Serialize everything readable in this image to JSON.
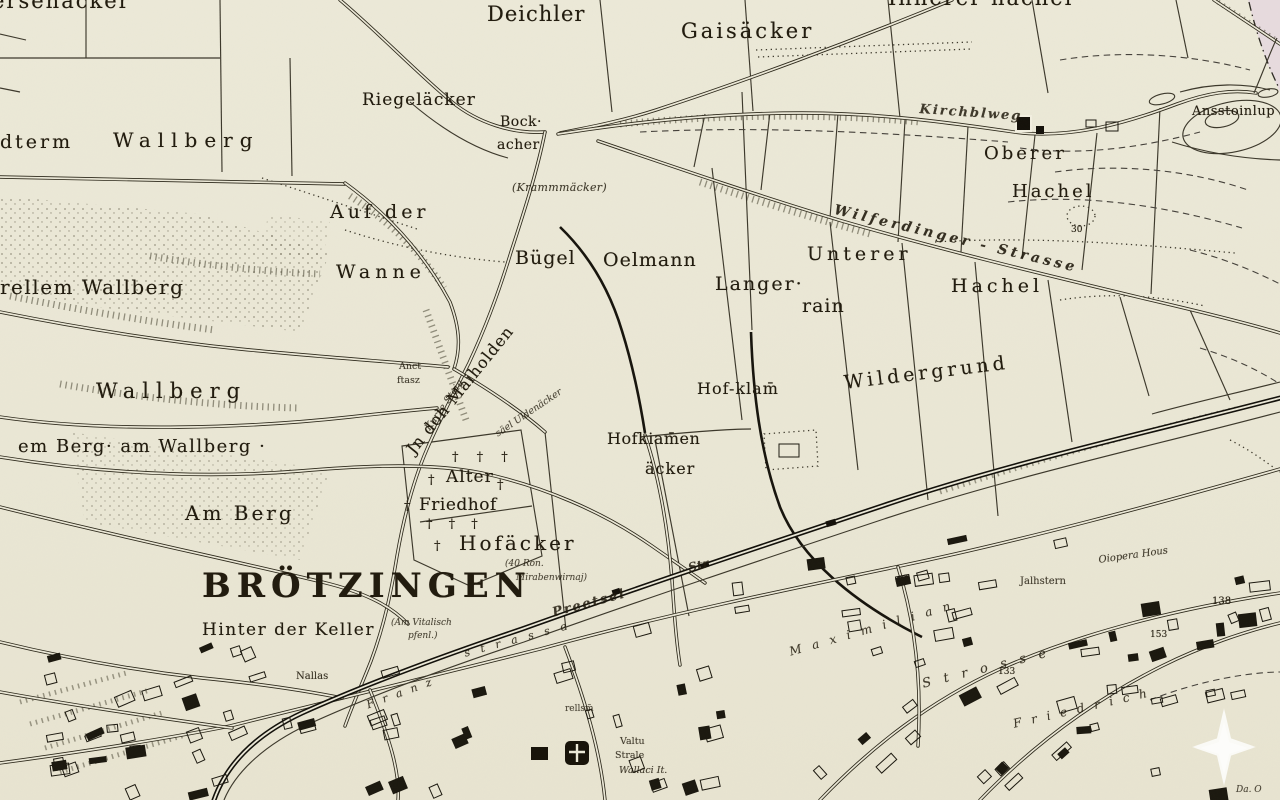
{
  "map": {
    "town_name": "BRÖTZINGEN",
    "colors": {
      "paper": "#ebe8d7",
      "ink": "#211c10",
      "edge_pink": "#e7dade",
      "railway_ink": "#12100a",
      "highlight": "rgba(255,255,255,0.78)"
    },
    "overlay_icon": "four-pointed-star-highlight",
    "labels": [
      {
        "id": "ersenaecker",
        "text": "ersenäcker",
        "x": -8,
        "y": -9,
        "s": 21,
        "ls": 2
      },
      {
        "id": "deichler",
        "text": "Deichler",
        "x": 487,
        "y": 4,
        "s": 21,
        "ls": 1
      },
      {
        "id": "gaisaecker",
        "text": "Gaisäcker",
        "x": 681,
        "y": 21,
        "s": 21,
        "ls": 3
      },
      {
        "id": "innerer-hachel",
        "text": "Innerer hachel",
        "x": 888,
        "y": -12,
        "s": 21,
        "ls": 2
      },
      {
        "id": "dterm",
        "text": "dterm",
        "x": 0,
        "y": 133,
        "s": 19,
        "ls": 3
      },
      {
        "id": "wallberg-nw",
        "text": "Wallberg",
        "x": 113,
        "y": 130,
        "s": 20,
        "ls": 7
      },
      {
        "id": "riegelaecker",
        "text": "Riegeläcker",
        "x": 362,
        "y": 92,
        "s": 17,
        "ls": 1
      },
      {
        "id": "bock",
        "text": "Bock·",
        "x": 500,
        "y": 115,
        "s": 14,
        "ls": 0.5
      },
      {
        "id": "acher",
        "text": "acher",
        "x": 497,
        "y": 138,
        "s": 14,
        "ls": 0.5
      },
      {
        "id": "krammaecker",
        "text": "(Krammmäcker)",
        "x": 512,
        "y": 182,
        "s": 11,
        "ls": 0.3,
        "it": 1,
        "op": 0.85
      },
      {
        "id": "auf-der",
        "text": "Auf der",
        "x": 330,
        "y": 203,
        "s": 19,
        "ls": 4
      },
      {
        "id": "wanne",
        "text": "Wanne",
        "x": 336,
        "y": 263,
        "s": 19,
        "ls": 5
      },
      {
        "id": "oberer",
        "text": "Oberer",
        "x": 984,
        "y": 145,
        "s": 18,
        "ls": 3
      },
      {
        "id": "hachel-oberer",
        "text": "Hachel",
        "x": 1012,
        "y": 183,
        "s": 18,
        "ls": 3
      },
      {
        "id": "buegel",
        "text": "Bügel",
        "x": 515,
        "y": 249,
        "s": 19,
        "ls": 1
      },
      {
        "id": "oelmann",
        "text": "Oelmann",
        "x": 603,
        "y": 251,
        "s": 19,
        "ls": 1
      },
      {
        "id": "langer",
        "text": "Langer·",
        "x": 715,
        "y": 275,
        "s": 19,
        "ls": 2
      },
      {
        "id": "rain",
        "text": "rain",
        "x": 802,
        "y": 297,
        "s": 19,
        "ls": 1
      },
      {
        "id": "unterer",
        "text": "Unterer",
        "x": 807,
        "y": 245,
        "s": 19,
        "ls": 4
      },
      {
        "id": "hachel-unterer",
        "text": "Hachel",
        "x": 951,
        "y": 277,
        "s": 19,
        "ls": 4
      },
      {
        "id": "wilferdinger-strasse",
        "text": "Wilferdinger - Strasse",
        "x": 836,
        "y": 203,
        "s": 14,
        "ls": 3.5,
        "rot": 13.5,
        "it": 1,
        "b": 1,
        "op": 0.9
      },
      {
        "id": "kirchblweg",
        "text": "Kirchblweg",
        "x": 920,
        "y": 103,
        "s": 13,
        "ls": 2,
        "rot": 4,
        "it": 1,
        "b": 1,
        "op": 0.85
      },
      {
        "id": "rellem-wallberg",
        "text": "rellem Wallberg",
        "x": 0,
        "y": 277,
        "s": 20,
        "ls": 1.5
      },
      {
        "id": "wallberg",
        "text": "Wallberg",
        "x": 96,
        "y": 381,
        "s": 21,
        "ls": 7
      },
      {
        "id": "am-wallberg",
        "text": "em Berg· am Wallberg ·",
        "x": 18,
        "y": 438,
        "s": 18,
        "ls": 1.5
      },
      {
        "id": "am-berg",
        "text": "Am Berg",
        "x": 185,
        "y": 503,
        "s": 20,
        "ls": 3
      },
      {
        "id": "wildergrund",
        "text": "Wildergrund",
        "x": 843,
        "y": 374,
        "s": 19,
        "ls": 4,
        "rot": -7
      },
      {
        "id": "hof-klam",
        "text": "Hof-klam̄",
        "x": 697,
        "y": 381,
        "s": 16,
        "ls": 1
      },
      {
        "id": "hofkiamen",
        "text": "Hofkiam̄en",
        "x": 607,
        "y": 431,
        "s": 16,
        "ls": 0.5
      },
      {
        "id": "hofkiamen-aecker",
        "text": "äcker",
        "x": 645,
        "y": 461,
        "s": 16,
        "ls": 1
      },
      {
        "id": "jn-doh-maiholden",
        "text": "Jn doh Maiholden",
        "x": 404,
        "y": 447,
        "s": 16,
        "ls": 1,
        "rot": -51
      },
      {
        "id": "kurze-steig",
        "text": "Kurze Steig",
        "x": 424,
        "y": 427,
        "s": 10,
        "rot": -55,
        "it": 1,
        "op": 0.8
      },
      {
        "id": "anct",
        "text": "Anct",
        "x": 399,
        "y": 362,
        "s": 9.5,
        "op": 0.85
      },
      {
        "id": "ftasz",
        "text": "ftasz",
        "x": 397,
        "y": 376,
        "s": 9.5,
        "op": 0.85
      },
      {
        "id": "uldenaecker",
        "text": "säel Uldenäcker",
        "x": 494,
        "y": 431,
        "s": 9.5,
        "rot": -34,
        "it": 1,
        "op": 0.8
      },
      {
        "id": "crosses-1",
        "text": "† † †",
        "x": 452,
        "y": 451,
        "s": 13,
        "ls": 7
      },
      {
        "id": "cross-a",
        "text": "†",
        "x": 428,
        "y": 474,
        "s": 13
      },
      {
        "id": "alter",
        "text": "Alter",
        "x": 446,
        "y": 469,
        "s": 17,
        "ls": 1
      },
      {
        "id": "cross-b",
        "text": "†",
        "x": 497,
        "y": 479,
        "s": 13
      },
      {
        "id": "cross-c",
        "text": "†",
        "x": 404,
        "y": 500,
        "s": 13
      },
      {
        "id": "friedhof",
        "text": "Friedhof",
        "x": 419,
        "y": 497,
        "s": 17,
        "ls": 0.5
      },
      {
        "id": "crosses-2",
        "text": "† † †",
        "x": 426,
        "y": 518,
        "s": 13,
        "ls": 6
      },
      {
        "id": "cross-d",
        "text": "†",
        "x": 434,
        "y": 540,
        "s": 13
      },
      {
        "id": "hofaecker",
        "text": "Hofäcker",
        "x": 459,
        "y": 533,
        "s": 20,
        "ls": 3
      },
      {
        "id": "broetzingen",
        "text": "BRÖTZINGEN",
        "x": 202,
        "y": 569,
        "s": 34,
        "ls": 6,
        "b": 1
      },
      {
        "id": "hinter-der-keller",
        "text": "Hinter der Keller",
        "x": 202,
        "y": 622,
        "s": 17,
        "ls": 1.5
      },
      {
        "id": "am-vital-1",
        "text": "(Am Vitalisch",
        "x": 391,
        "y": 619,
        "s": 9,
        "it": 1,
        "op": 0.8
      },
      {
        "id": "am-vital-2",
        "text": "pfenl.)",
        "x": 408,
        "y": 632,
        "s": 9,
        "it": 1,
        "op": 0.8
      },
      {
        "id": "ron-1",
        "text": "(40 Ron.",
        "x": 505,
        "y": 560,
        "s": 9,
        "it": 1,
        "op": 0.8
      },
      {
        "id": "ron-2",
        "text": "Mirabenwirnaj)",
        "x": 516,
        "y": 574,
        "s": 9,
        "it": 1,
        "op": 0.8
      },
      {
        "id": "nallas",
        "text": "Nallas",
        "x": 296,
        "y": 672,
        "s": 10,
        "op": 0.9
      },
      {
        "id": "preetsel",
        "text": "Preetsel",
        "x": 551,
        "y": 607,
        "s": 13,
        "ls": 2,
        "rot": -15,
        "it": 1,
        "b": 1,
        "op": 0.85
      },
      {
        "id": "str",
        "text": "Str",
        "x": 687,
        "y": 562,
        "s": 12,
        "rot": -14,
        "it": 1,
        "b": 1,
        "op": 0.85
      },
      {
        "id": "franz",
        "text": "Franz",
        "x": 365,
        "y": 700,
        "s": 11,
        "ls": 9,
        "rot": -20,
        "it": 1,
        "op": 0.85
      },
      {
        "id": "strasse-sw",
        "text": "strasse",
        "x": 463,
        "y": 648,
        "s": 11,
        "ls": 11,
        "rot": -15,
        "it": 1,
        "op": 0.85
      },
      {
        "id": "maximilian",
        "text": "Maximilian",
        "x": 788,
        "y": 646,
        "s": 12,
        "ls": 11,
        "rot": -16,
        "it": 1,
        "op": 0.85
      },
      {
        "id": "strosse",
        "text": "Strosse",
        "x": 921,
        "y": 678,
        "s": 13,
        "ls": 13,
        "rot": -14,
        "it": 1,
        "op": 0.85
      },
      {
        "id": "friedrich",
        "text": "Friedrich",
        "x": 1012,
        "y": 718,
        "s": 12,
        "ls": 10,
        "rot": -13,
        "it": 1,
        "op": 0.85
      },
      {
        "id": "jalhstern",
        "text": "Jalhstern",
        "x": 1020,
        "y": 577,
        "s": 10,
        "op": 0.85
      },
      {
        "id": "oiopera-hous",
        "text": "Oiopera Hous",
        "x": 1098,
        "y": 556,
        "s": 10,
        "it": 1,
        "rot": -8,
        "op": 0.85
      },
      {
        "id": "n138",
        "text": "138",
        "x": 1212,
        "y": 597,
        "s": 10
      },
      {
        "id": "n153",
        "text": "153",
        "x": 1150,
        "y": 631,
        "s": 9
      },
      {
        "id": "n133",
        "text": "133",
        "x": 998,
        "y": 668,
        "s": 9
      },
      {
        "id": "n30",
        "text": "30",
        "x": 1071,
        "y": 226,
        "s": 9
      },
      {
        "id": "ansstoinlup",
        "text": "Ansstoinlup",
        "x": 1192,
        "y": 105,
        "s": 13,
        "ls": 0.5
      },
      {
        "id": "rellsm",
        "text": "rellsm̃",
        "x": 565,
        "y": 705,
        "s": 9,
        "op": 0.8
      },
      {
        "id": "valtu",
        "text": "Valtu",
        "x": 620,
        "y": 737,
        "s": 9.5,
        "op": 0.85
      },
      {
        "id": "strale",
        "text": "Strale",
        "x": 615,
        "y": 751,
        "s": 9.5,
        "op": 0.85
      },
      {
        "id": "wallaci",
        "text": "Wallaci It.",
        "x": 619,
        "y": 766,
        "s": 9.5,
        "it": 1,
        "op": 0.85
      },
      {
        "id": "da-o",
        "text": "Da. O",
        "x": 1236,
        "y": 786,
        "s": 9,
        "it": 1,
        "op": 0.8
      }
    ]
  }
}
